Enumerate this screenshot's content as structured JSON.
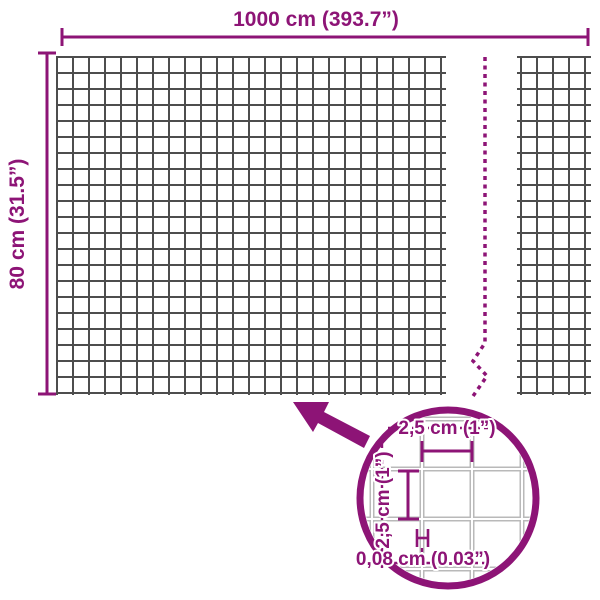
{
  "diagram": {
    "overall": {
      "width_label": "1000 cm (393.7”)",
      "height_label": "80 cm (31.5”)"
    },
    "detail": {
      "mesh_width_label": "2,5 cm (1”)",
      "mesh_height_label": "2,5 cm (1”)",
      "wire_thickness_label": "0,08 cm (0.03”)"
    },
    "colors": {
      "accent": "#8d1476",
      "mesh_wire": "#4d4d4d",
      "detail_wire": "#b9b9b9",
      "background": "#ffffff"
    }
  }
}
